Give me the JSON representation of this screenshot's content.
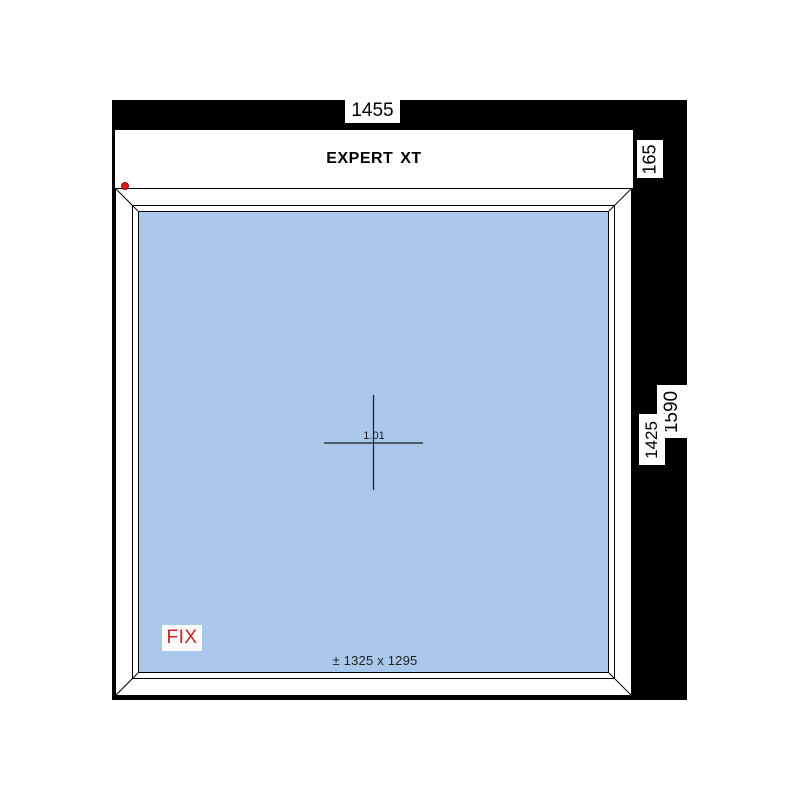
{
  "drawing": {
    "system_name": "EXPERT XT",
    "position_number": "1.01",
    "opening_type": "FIX",
    "glass_dimensions": "± 1325 x 1295",
    "dims": {
      "total_width": "1455",
      "header_height": "165",
      "total_height": "1590",
      "frame_height": "1425"
    }
  },
  "colors": {
    "glass_blue": "#a9c8eb",
    "marker_red": "#e51616",
    "fix_red": "#e01a1a",
    "line_black": "#000000"
  }
}
